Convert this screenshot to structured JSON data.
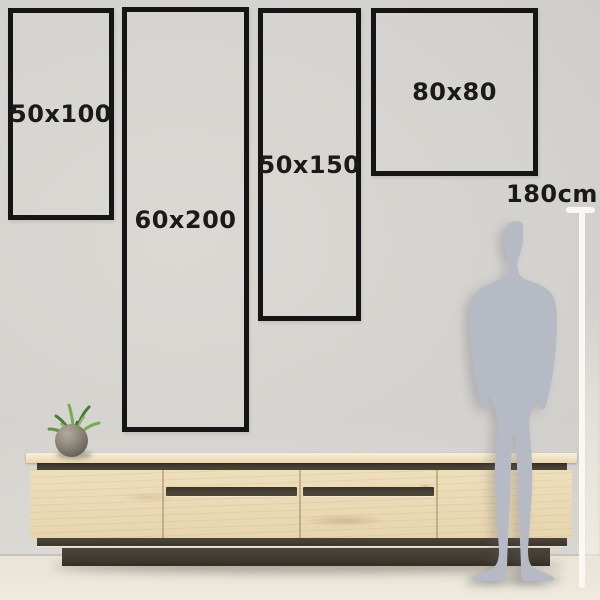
{
  "meta": {
    "description_label": "Wall art size comparison guide"
  },
  "frames": [
    {
      "label": "50x100",
      "width_cm": 50,
      "height_cm": 100
    },
    {
      "label": "60x200",
      "width_cm": 60,
      "height_cm": 200
    },
    {
      "label": "50x150",
      "width_cm": 50,
      "height_cm": 150
    },
    {
      "label": "80x80",
      "width_cm": 80,
      "height_cm": 80
    }
  ],
  "ruler": {
    "label": "180cm",
    "height_cm": 180
  },
  "colors": {
    "wall": "#d4d2ce",
    "wall-light": "#dbd8d4",
    "wall-dark": "#c7c5c1",
    "floor": "#ece7da",
    "floor-line": "#c9c4b7",
    "frame-border": "#151515",
    "label-text": "#1a1a1a",
    "silhouette": "#b6bac4",
    "ruler-line": "#faf8f3",
    "wood": "#eedebb",
    "wood-top": "#f2e6c6",
    "groove": "#4c4537",
    "plinth": "#413c31",
    "pot": "#8a8478",
    "plant-dark": "#4a7a33",
    "plant-light": "#76ad4a"
  }
}
